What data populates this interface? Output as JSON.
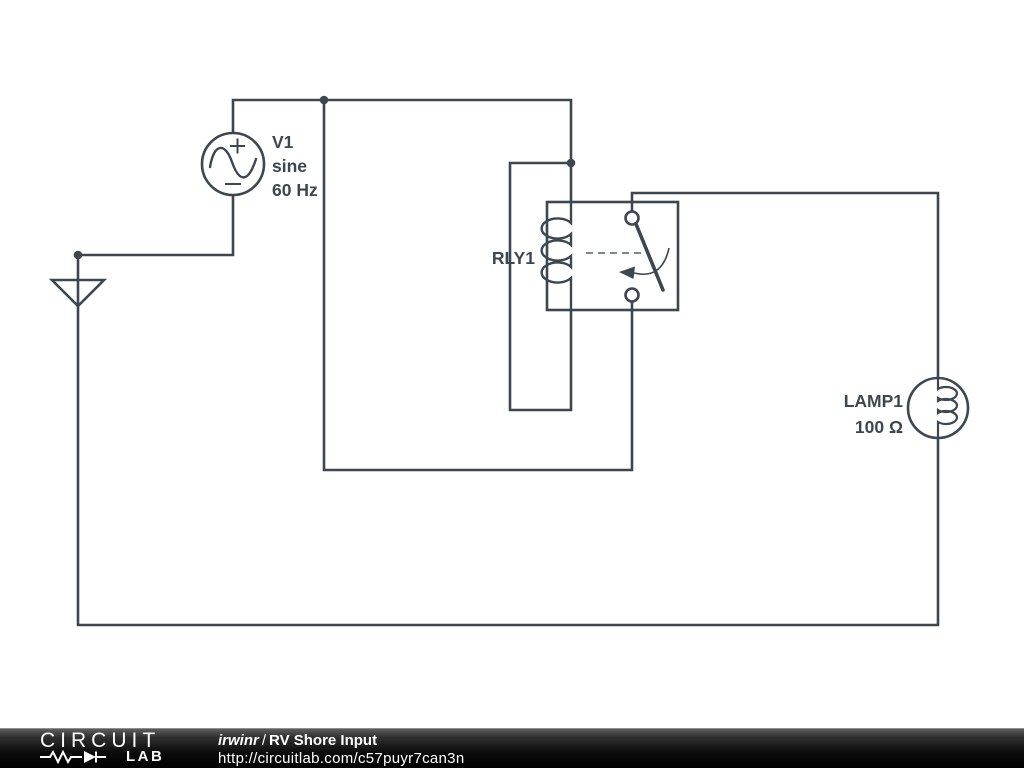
{
  "schematic": {
    "components": {
      "v1": {
        "lines": [
          "V1",
          "sine",
          "60 Hz"
        ]
      },
      "rly1": {
        "label": "RLY1"
      },
      "lamp1": {
        "lines": [
          "LAMP1",
          "100 Ω"
        ]
      }
    },
    "icons": [
      "ground-icon",
      "sine-source-icon",
      "relay-coil-icon",
      "relay-switch-icon",
      "lamp-filament-icon",
      "junction-dot"
    ],
    "colors": {
      "wire": "#3d474f",
      "dashed_link": "#7f888f",
      "background": "#ffffff"
    }
  },
  "footer": {
    "logo": {
      "word1": "CIRCUIT",
      "word2": "LAB",
      "icons": [
        "resistor-icon",
        "diode-icon"
      ]
    },
    "author": "irwinr",
    "separator": "/",
    "title": "RV Shore Input",
    "url": "http://circuitlab.com/c57puyr7can3n",
    "colors": {
      "bar_top": "#5d5d5d",
      "bar_bottom": "#000000",
      "text": "#ffffff"
    }
  }
}
